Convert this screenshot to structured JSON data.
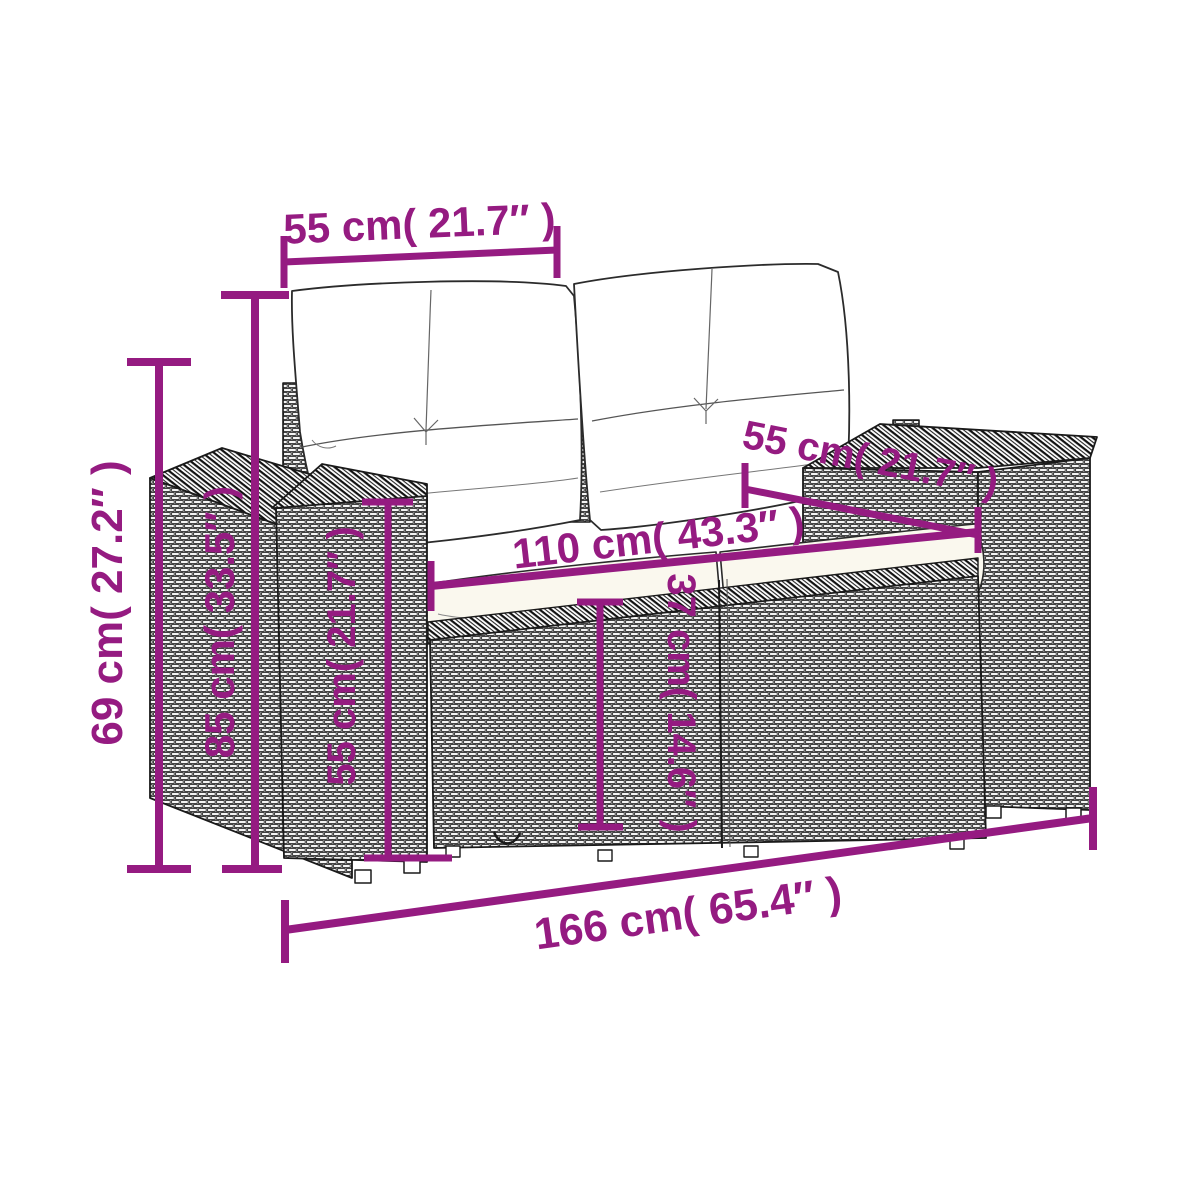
{
  "figure_description": "Rattan garden 2-seater sofa with white cushions — product dimension diagram",
  "accent_color": "#951b81",
  "line_color": "#1a1a1a",
  "dims": {
    "back_cushion_width": "55 cm( 21.7″ )",
    "overall_height": "69 cm( 27.2″ )",
    "backrest_height": "85 cm( 33.5″ )",
    "armrest_height": "55 cm( 21.7″ )",
    "seat_height": "37 cm( 14.6″ )",
    "seat_width": "110 cm( 43.3″ )",
    "seat_depth": "55 cm( 21.7″ )",
    "overall_width": "166 cm( 65.4″ )"
  }
}
